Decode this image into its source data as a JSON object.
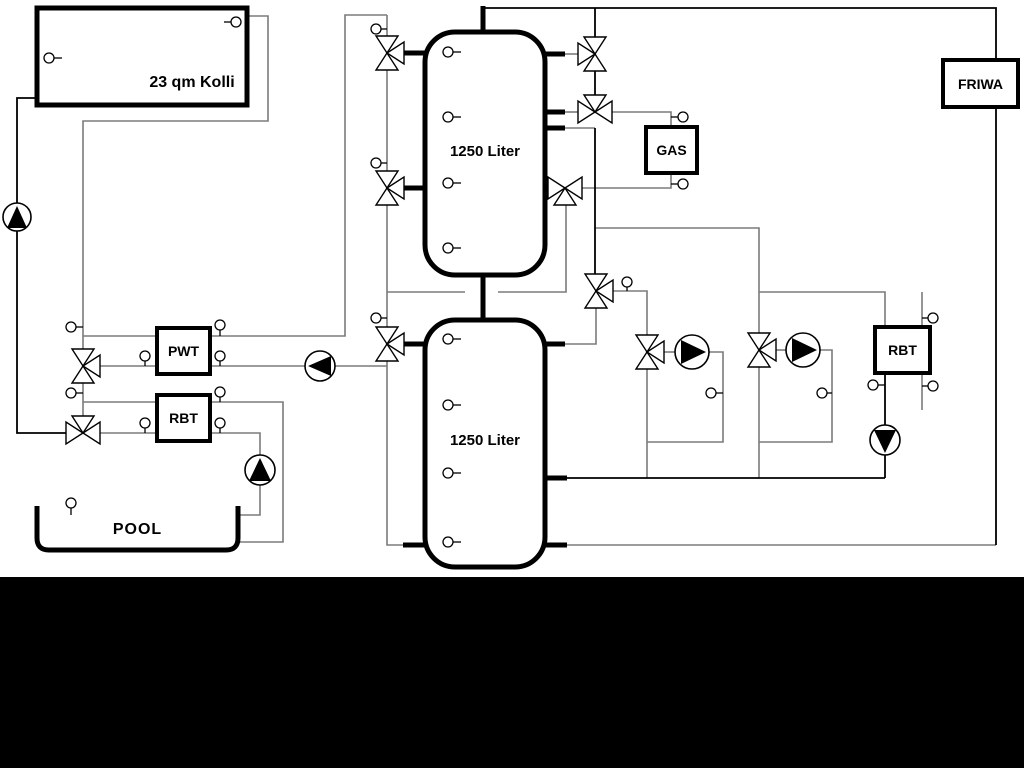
{
  "diagram": {
    "type": "hydraulic-heating-schematic",
    "background_color": "#ffffff",
    "bottom_bar_color": "#000000",
    "pipe_gray": "#7b7b7b",
    "pipe_black": "#000000",
    "labels": {
      "collector": "23 qm Kolli",
      "tank1": "1250 Liter",
      "tank2": "1250 Liter",
      "gas": "GAS",
      "friwa": "FRIWA",
      "pwt": "PWT",
      "rbt_left": "RBT",
      "rbt_right": "RBT",
      "pool": "POOL"
    },
    "components": {
      "pumps": 6,
      "three_way_valves": 11,
      "temperature_sensors": 27,
      "buffer_tanks": 2
    }
  }
}
